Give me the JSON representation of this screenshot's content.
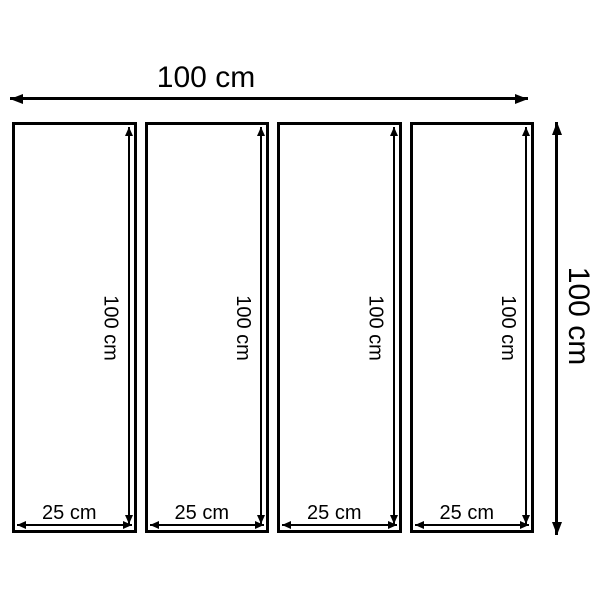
{
  "diagram": {
    "description": "Dimension diagram of a 4-panel set",
    "overall_width_label": "100 cm",
    "overall_height_label": "100 cm",
    "panels": [
      {
        "width_label": "25 cm",
        "height_label": "100 cm"
      },
      {
        "width_label": "25 cm",
        "height_label": "100 cm"
      },
      {
        "width_label": "25 cm",
        "height_label": "100 cm"
      },
      {
        "width_label": "25 cm",
        "height_label": "100 cm"
      }
    ],
    "colors": {
      "line": "#000000",
      "text": "#000000",
      "background": "#ffffff"
    }
  }
}
